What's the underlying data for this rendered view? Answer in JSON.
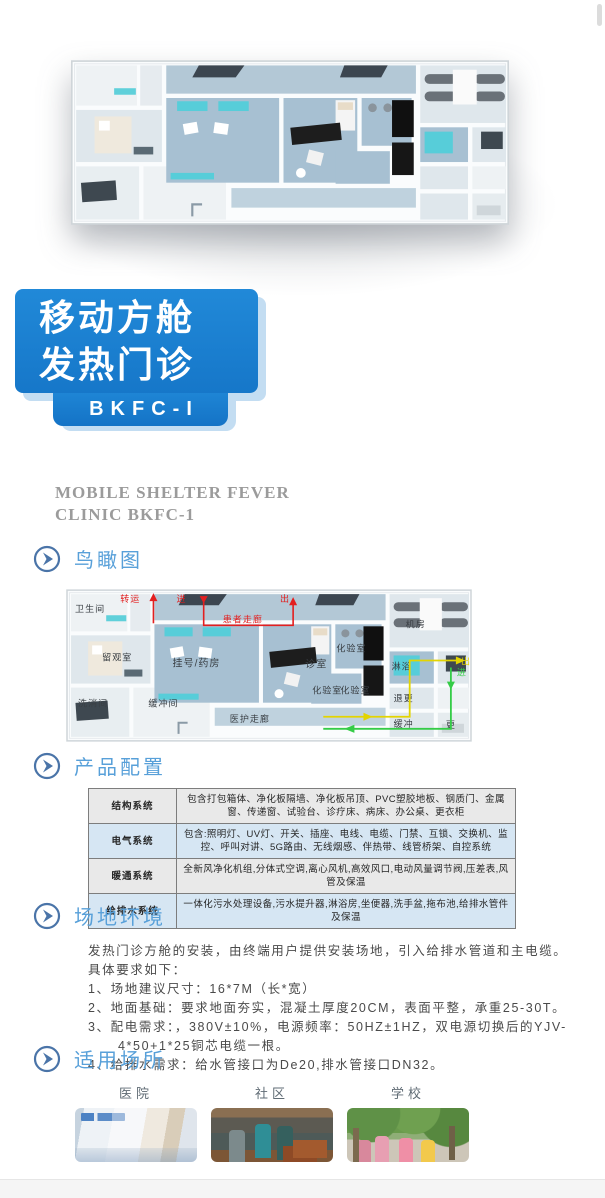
{
  "banner": {
    "line1": "移动方舱",
    "line2": "发热门诊",
    "model": "BKFC-I"
  },
  "subtitle": {
    "line1": "MOBILE SHELTER FEVER",
    "line2": "CLINIC  BKFC-1"
  },
  "sections": {
    "aerial": {
      "title": "鸟瞰图"
    },
    "config": {
      "title": "产品配置"
    },
    "site": {
      "title": "场地环境"
    },
    "places": {
      "title": "适用场所"
    }
  },
  "config_table": {
    "rows": [
      {
        "label": "结构系统",
        "value": "包含打包箱体、净化板隔墙、净化板吊顶、PVC塑胶地板、钢质门、金属窗、传递窗、试验台、诊疗床、病床、办公桌、更衣柜"
      },
      {
        "label": "电气系统",
        "value": "包含:照明灯、UV灯、开关、插座、电线、电缆、门禁、互锁、交换机、监控、呼叫对讲、5G路由、无线烟感、伴热带、线管桥架、自控系统"
      },
      {
        "label": "暖通系统",
        "value": "全新风净化机组,分体式空调,离心风机,高效风口,电动风量调节阀,压差表,风管及保温"
      },
      {
        "label": "给排水系统",
        "value": "一体化污水处理设备,污水提升器,淋浴房,坐便器,洗手盆,拖布池,给排水管件及保温"
      }
    ]
  },
  "site": {
    "intro": "发热门诊方舱的安装，由终端用户提供安装场地，引入给排水管道和主电缆。",
    "lead": "具体要求如下：",
    "items": [
      "1、场地建议尺寸：16*7M（长*宽）",
      "2、地面基础：要求地面夯实，混凝土厚度20CM，表面平整，承重25-30T。",
      "3、配电需求：，380V±10%，电源频率：50HZ±1HZ，双电源切换后的YJV-4*50+1*25铜芯电缆一根。",
      "4、给排水需求：给水管接口为De20,排水管接口DN32。"
    ]
  },
  "places": [
    {
      "label": "医院"
    },
    {
      "label": "社区"
    },
    {
      "label": "学校"
    }
  ],
  "floorplan": {
    "rooms": {
      "toilet": "卫生间",
      "observation": "留观室",
      "washing": "洗消间",
      "buffer_room": "缓冲间",
      "registration": "挂号/药房",
      "consult": "诊室",
      "lab_top": "化验室",
      "lab_b1": "化验室",
      "lab_b2": "化验室",
      "machine": "机房",
      "shower": "淋浴",
      "undress": "退更",
      "buffer": "缓冲",
      "change": "更",
      "patient_corridor": "患者走廊",
      "staff_corridor": "医护走廊"
    },
    "flows": {
      "transfer": "转运",
      "enter_red": "进",
      "exit_red": "出",
      "exit_yellow": "出",
      "enter_green": "进"
    }
  },
  "colors": {
    "banner_blue": "#1a80d2",
    "banner_shadow": "#c3ddf2",
    "section_title_blue": "#58a0d9",
    "table_row_gray": "#e9e9e9",
    "table_row_blue": "#d6e6f3",
    "flow_red": "#e31f1f",
    "flow_yellow": "#e3d400",
    "flow_green": "#35cc47",
    "floor_blue": "#a7c0d2",
    "accent_teal": "#57cdd9"
  }
}
